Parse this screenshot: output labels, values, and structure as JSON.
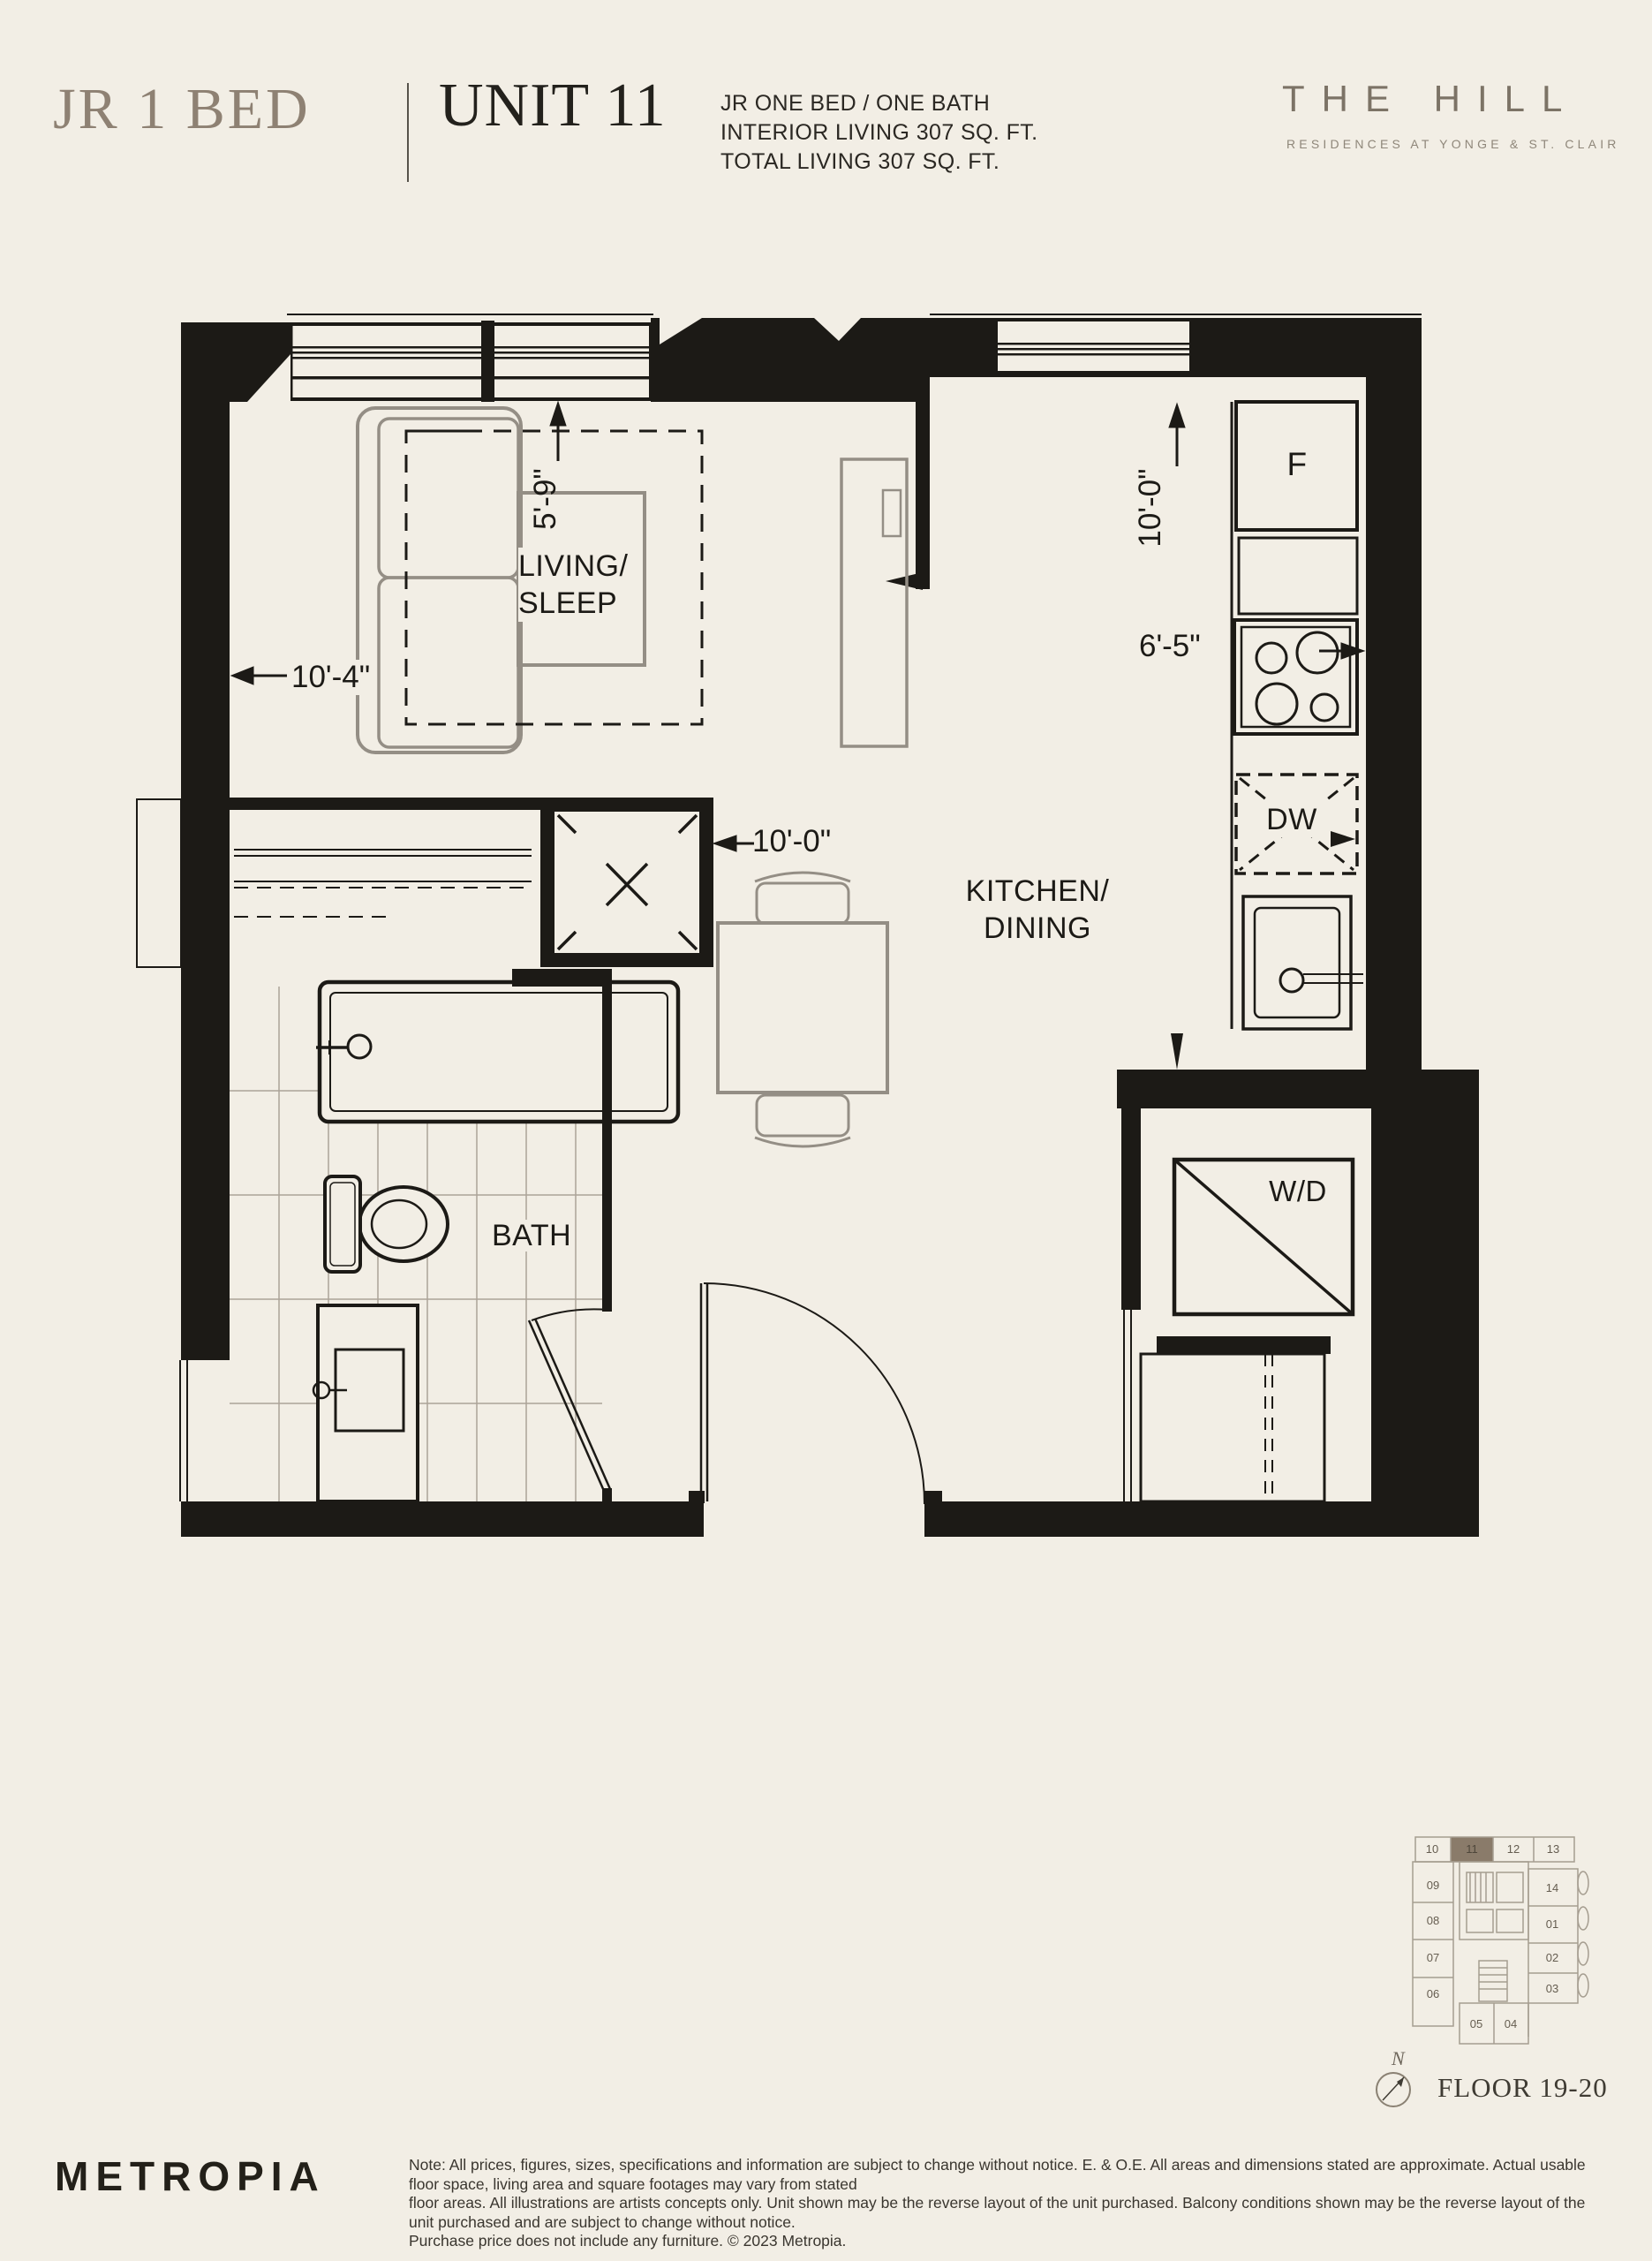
{
  "header": {
    "plan_type": "JR 1 BED",
    "unit": "UNIT 11",
    "specs": [
      "JR ONE BED / ONE BATH",
      "INTERIOR LIVING 307 SQ. FT.",
      "TOTAL LIVING 307 SQ. FT."
    ],
    "brand": "THE HILL",
    "brand_subtitle": "RESIDENCES AT YONGE & ST. CLAIR"
  },
  "plan": {
    "rooms": {
      "living_sleep_line1": "LIVING/",
      "living_sleep_line2": "SLEEP",
      "kitchen_dining_line1": "KITCHEN/",
      "kitchen_dining_line2": "DINING",
      "bath": "BATH"
    },
    "appliances": {
      "fridge": "F",
      "dishwasher": "DW",
      "washer_dryer": "W/D"
    },
    "dimensions": {
      "living_width": "10'-4\"",
      "living_depth": "5'-9\"",
      "closet_width": "10'-0\"",
      "kitchen_depth": "10'-0\"",
      "kitchen_width": "6'-5\""
    }
  },
  "keyplan": {
    "top_row": [
      "10",
      "11",
      "12",
      "13"
    ],
    "left_col": [
      "09",
      "08",
      "07",
      "06"
    ],
    "right_col": [
      "14",
      "01",
      "02",
      "03"
    ],
    "bottom_row": [
      "05",
      "04"
    ],
    "highlighted_unit": "11",
    "compass": "N",
    "floor_label": "FLOOR 19-20"
  },
  "footer": {
    "logo": "METROPIA",
    "disclaimer_lines": [
      "Note: All prices, figures, sizes, specifications and information are subject to change without notice. E. & O.E. All areas and dimensions stated are approximate. Actual usable floor space, living area and square footages may vary from stated",
      "floor areas. All illustrations are artists concepts only. Unit shown may be the reverse layout of the unit purchased. Balcony conditions shown may be the reverse layout of the unit purchased and are subject to change without notice.",
      "Purchase price does not include any furniture. © 2023 Metropia."
    ]
  },
  "colors": {
    "accent_taupe": "#8e8173",
    "plan_ink": "#1c1a16",
    "highlight": "#8a7b6a",
    "background": "#f2eee5"
  }
}
